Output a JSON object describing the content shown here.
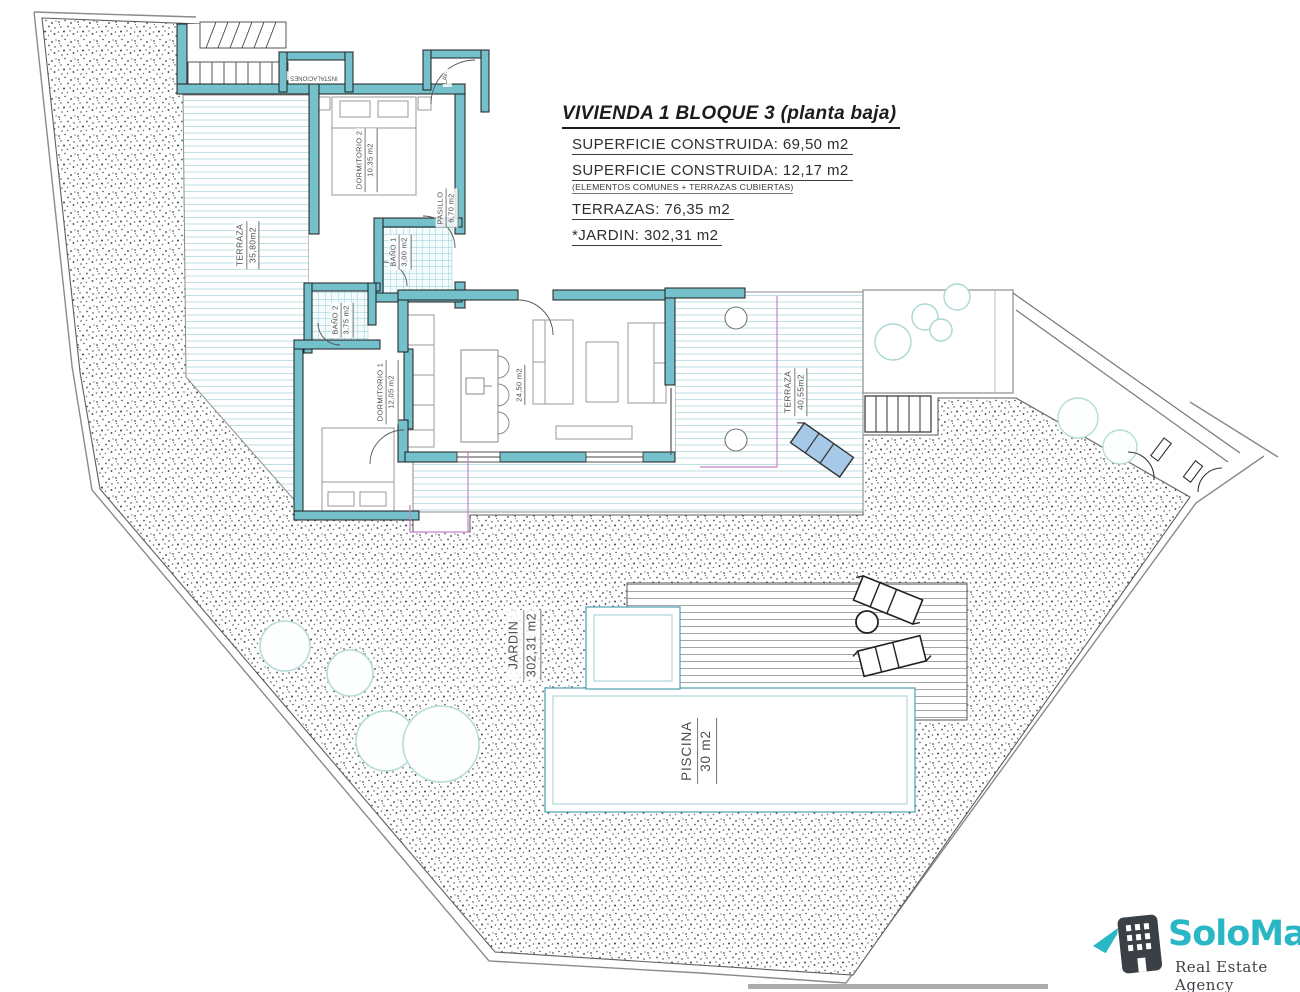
{
  "title_block": {
    "title": "VIVIENDA 1 BLOQUE 3",
    "title_suffix": " (planta baja)",
    "line1": "SUPERFICIE CONSTRUIDA: 69,50 m2",
    "line2": "SUPERFICIE CONSTRUIDA: 12,17 m2",
    "line2_note": "(ELEMENTOS COMUNES + TERRAZAS CUBIERTAS)",
    "line3": "TERRAZAS: 76,35 m2",
    "line4": "*JARDIN: 302,31 m2"
  },
  "labels": {
    "terraza_nw": {
      "name": "TERRAZA",
      "area": "35,80m2"
    },
    "dormitorio2": {
      "name": "DORMITORIO 2",
      "area": "10,35 m2"
    },
    "pasillo": {
      "name": "PASILLO",
      "area": "6,70 m2"
    },
    "bano1": {
      "name": "BAÑO 1",
      "area": "3,00 m2"
    },
    "bano2": {
      "name": "BAÑO 2",
      "area": "3,75 m2"
    },
    "dormitorio1": {
      "name": "DORMITORIO 1",
      "area": "12,05 m2"
    },
    "salon": {
      "area": "24,50 m2"
    },
    "instalaciones": {
      "name": "INSTALACIONES"
    },
    "lavadero": {
      "name": "LAV."
    },
    "terraza_e": {
      "name": "TERRAZA",
      "area": "40,55m2"
    },
    "jardin": {
      "name": "JARDIN",
      "area": "302,31 m2"
    },
    "piscina": {
      "name": "PISCINA",
      "area": "30 m2"
    }
  },
  "logo": {
    "brand": "SoloMar",
    "tagline": "Real Estate Agency"
  },
  "colors": {
    "wall_teal": "#74c0cb",
    "deck_line": "#bcdfe3",
    "pool_deck_line": "#9a9a9a",
    "tile_teal": "#6fc0ca",
    "boundary_gray": "#8a8a8a",
    "property_magenta": "#c981c9",
    "tree_stroke": "#b5dcd8",
    "lounger_blue": "#a5c9e6",
    "logo_teal": "#29b6c5",
    "logo_dark": "#3a4045"
  }
}
